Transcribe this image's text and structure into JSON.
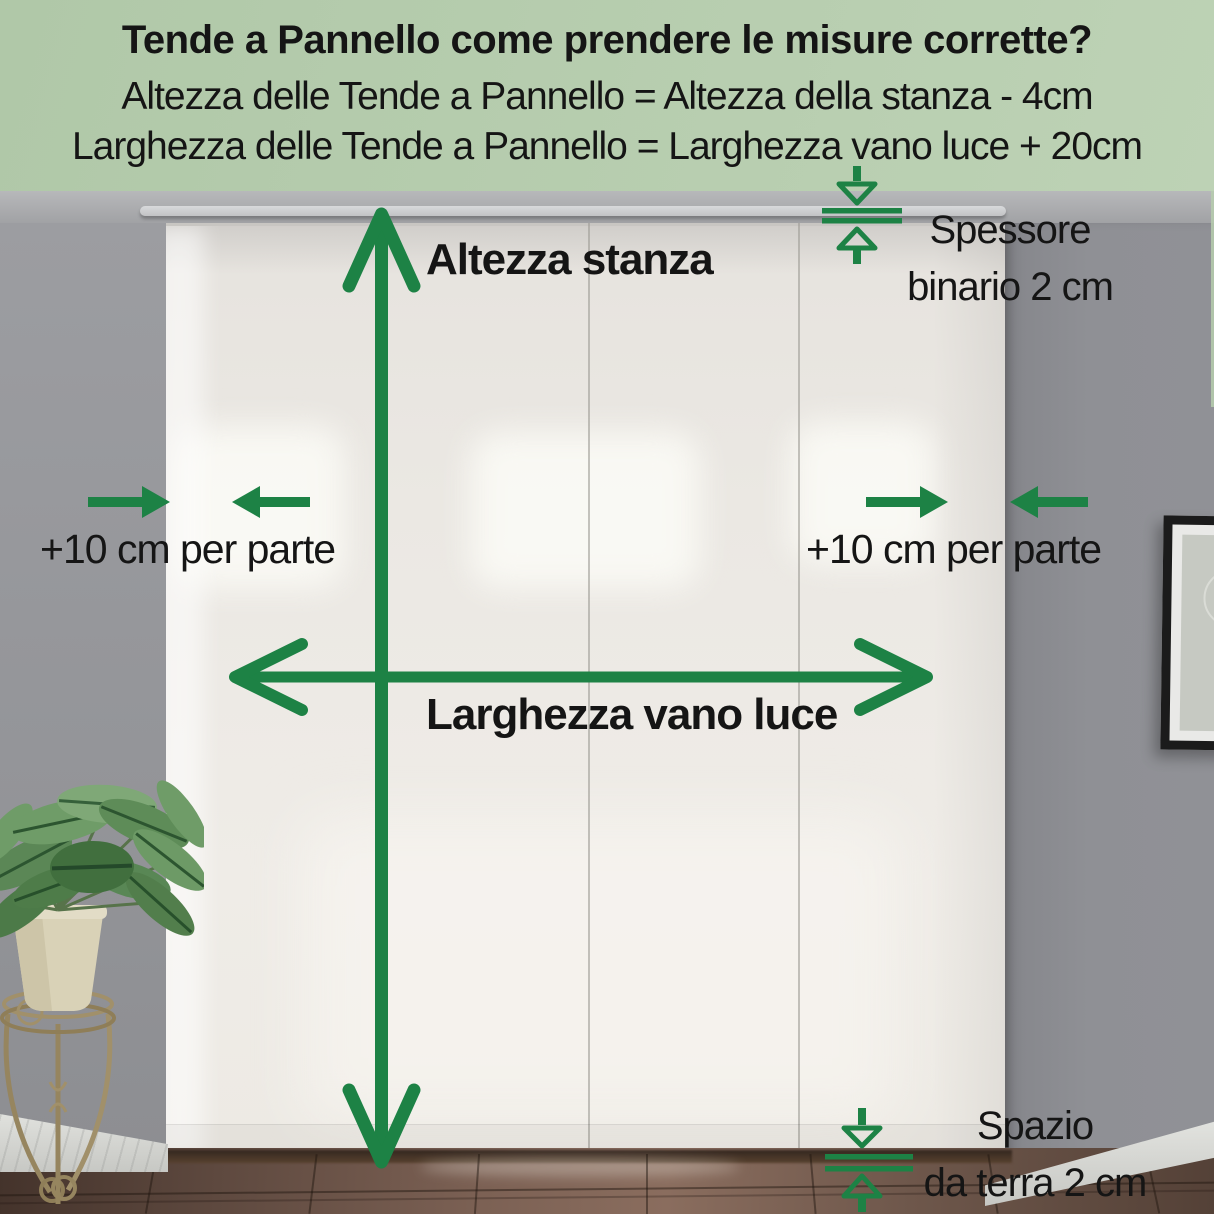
{
  "header": {
    "title": "Tende a Pannello come prendere le misure corrette?",
    "formula_height": "Altezza delle Tende a Pannello = Altezza della stanza - 4cm",
    "formula_width": "Larghezza delle Tende a Pannello = Larghezza vano luce + 20cm"
  },
  "annotations": {
    "room_height_label": "Altezza stanza",
    "opening_width_label": "Larghezza vano luce",
    "side_margin_left_label": "+10 cm per parte",
    "side_margin_right_label": "+10 cm per parte",
    "track_thickness_line1": "Spessore",
    "track_thickness_line2": "binario 2 cm",
    "floor_gap_line1": "Spazio",
    "floor_gap_line2": "da terra 2 cm"
  },
  "colors": {
    "accent_green": "#1d8245",
    "header_background_1": "#b0c8a8",
    "header_background_2": "#bdd2b5",
    "text_black": "#151515"
  },
  "icons": {
    "room_height_arrow": "double-arrow-vertical",
    "opening_width_arrow": "double-arrow-horizontal",
    "side_margin_arrows": "arrow-pair-inward",
    "track_thickness_arrows": "arrows-down-up-to-track-lines",
    "floor_gap_arrows": "arrows-down-up-to-gap-lines"
  }
}
